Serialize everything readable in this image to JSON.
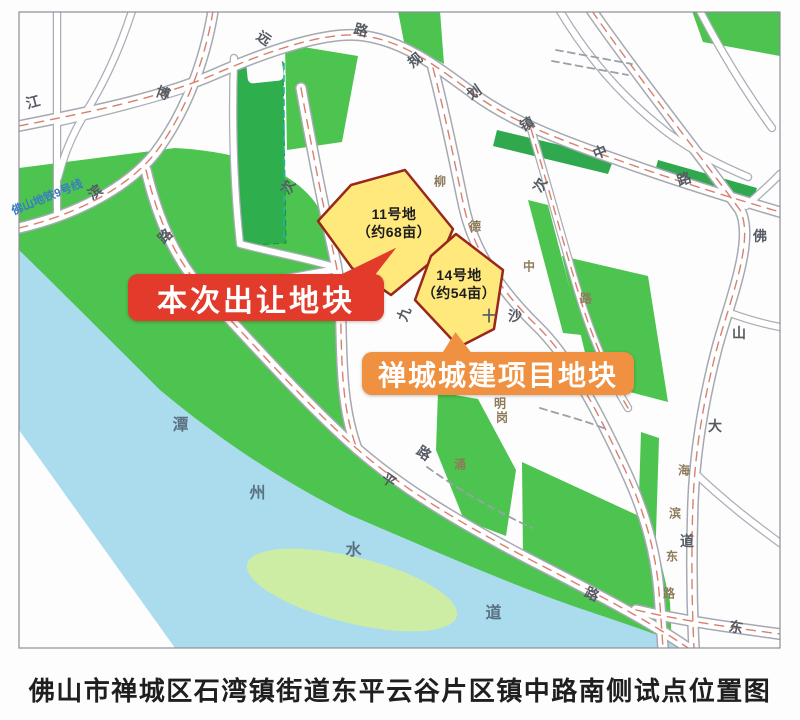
{
  "caption": "佛山市禅城区石湾镇街道东平云谷片区镇中路南侧试点位置图",
  "map": {
    "callouts": [
      {
        "text": "本次出让地块",
        "color": "#e23b2b"
      },
      {
        "text": "禅城城建项目地块",
        "color": "#ef9140"
      }
    ],
    "parcels": [
      {
        "name": "11号地",
        "area": "（约68亩）"
      },
      {
        "name": "14号地",
        "area": "（约54亩）"
      }
    ],
    "metro_line_label": "佛山地铁9号线",
    "river_name": "潭州水道",
    "road_labels": [
      {
        "t": "江",
        "x": 33,
        "y": 102,
        "r": -15,
        "k": "std"
      },
      {
        "t": "博",
        "x": 163,
        "y": 93,
        "r": 20,
        "k": "std"
      },
      {
        "t": "远",
        "x": 264,
        "y": 38,
        "r": 35,
        "k": "std"
      },
      {
        "t": "路",
        "x": 361,
        "y": 30,
        "r": 15,
        "k": "std"
      },
      {
        "t": "规",
        "x": 415,
        "y": 60,
        "r": -38,
        "k": "std"
      },
      {
        "t": "划",
        "x": 474,
        "y": 92,
        "r": -35,
        "k": "std"
      },
      {
        "t": "镇",
        "x": 527,
        "y": 124,
        "r": -28,
        "k": "std"
      },
      {
        "t": "中",
        "x": 600,
        "y": 152,
        "r": -22,
        "k": "std"
      },
      {
        "t": "路",
        "x": 684,
        "y": 179,
        "r": -18,
        "k": "std"
      },
      {
        "t": "滨",
        "x": 95,
        "y": 192,
        "r": -35,
        "k": "std"
      },
      {
        "t": "路",
        "x": 165,
        "y": 236,
        "r": -45,
        "k": "std"
      },
      {
        "t": "次",
        "x": 288,
        "y": 187,
        "r": -65,
        "k": "std"
      },
      {
        "t": "次",
        "x": 540,
        "y": 185,
        "r": -65,
        "k": "std"
      },
      {
        "t": "九",
        "x": 404,
        "y": 314,
        "r": -70,
        "k": "std"
      },
      {
        "t": "十",
        "x": 489,
        "y": 316,
        "r": 0,
        "k": "std"
      },
      {
        "t": "沙",
        "x": 515,
        "y": 316,
        "r": 0,
        "k": "std"
      },
      {
        "t": "平",
        "x": 389,
        "y": 480,
        "r": 35,
        "k": "std"
      },
      {
        "t": "路",
        "x": 424,
        "y": 453,
        "r": 35,
        "k": "std"
      },
      {
        "t": "路",
        "x": 592,
        "y": 594,
        "r": 25,
        "k": "std"
      },
      {
        "t": "东",
        "x": 736,
        "y": 627,
        "r": 10,
        "k": "std"
      },
      {
        "t": "佛",
        "x": 760,
        "y": 236,
        "r": 0,
        "k": "std"
      },
      {
        "t": "山",
        "x": 739,
        "y": 333,
        "r": 0,
        "k": "std"
      },
      {
        "t": "大",
        "x": 715,
        "y": 426,
        "r": 0,
        "k": "std"
      },
      {
        "t": "道",
        "x": 687,
        "y": 541,
        "r": 0,
        "k": "std"
      },
      {
        "t": "柳",
        "x": 440,
        "y": 181,
        "r": 0,
        "k": "minor"
      },
      {
        "t": "德",
        "x": 475,
        "y": 226,
        "r": 0,
        "k": "minor"
      },
      {
        "t": "中",
        "x": 529,
        "y": 266,
        "r": 0,
        "k": "minor"
      },
      {
        "t": "路",
        "x": 586,
        "y": 298,
        "r": 0,
        "k": "minor"
      },
      {
        "t": "明",
        "x": 500,
        "y": 403,
        "r": 0,
        "k": "minor"
      },
      {
        "t": "岗",
        "x": 502,
        "y": 417,
        "r": 0,
        "k": "minor"
      },
      {
        "t": "涌",
        "x": 460,
        "y": 464,
        "r": 0,
        "k": "minor"
      },
      {
        "t": "海",
        "x": 684,
        "y": 470,
        "r": 0,
        "k": "minor"
      },
      {
        "t": "滨",
        "x": 675,
        "y": 513,
        "r": 0,
        "k": "minor"
      },
      {
        "t": "东",
        "x": 672,
        "y": 556,
        "r": 0,
        "k": "minor"
      },
      {
        "t": "路",
        "x": 669,
        "y": 593,
        "r": 0,
        "k": "minor"
      },
      {
        "t": "潭",
        "x": 181,
        "y": 423,
        "r": 0,
        "k": "water"
      },
      {
        "t": "州",
        "x": 258,
        "y": 491,
        "r": 0,
        "k": "water"
      },
      {
        "t": "水",
        "x": 354,
        "y": 548,
        "r": 0,
        "k": "water"
      },
      {
        "t": "道",
        "x": 494,
        "y": 611,
        "r": 0,
        "k": "water"
      }
    ],
    "colors": {
      "green": "#4cc44f",
      "dark_green": "#2fa84e",
      "river_blue": "#abdcee",
      "island_green": "#cdeda5",
      "parcel_fill": "#ffe97d",
      "parcel_border": "#99271b",
      "road_casing": "#a6a9b1",
      "road_center_dash": "#d97f6e",
      "metro_blue": "#3c7cc0",
      "banner_red": "#e23b2b",
      "banner_orange": "#ef9140"
    }
  }
}
